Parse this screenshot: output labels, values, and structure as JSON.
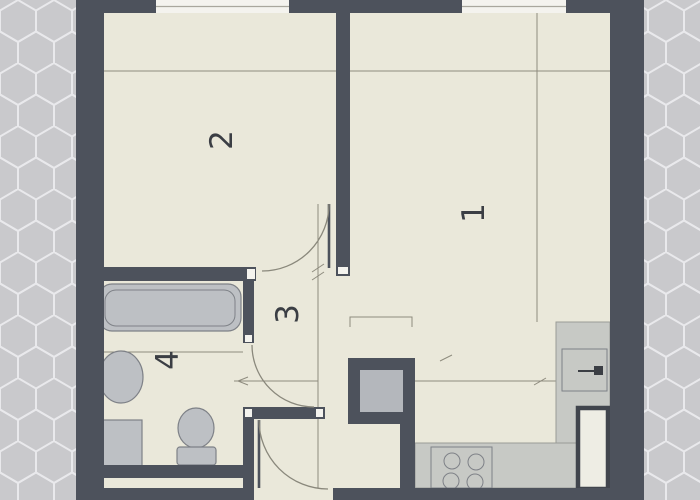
{
  "plan": {
    "rooms": [
      {
        "label": "1"
      },
      {
        "label": "2"
      },
      {
        "label": "3"
      },
      {
        "label": "4"
      }
    ]
  },
  "colors": {
    "hex-bg": "#c9c9cc",
    "hex-line": "#e9e9ec",
    "paper": "#eae8da",
    "wall": "#4d525c",
    "wall-cap": "#f4f3ee",
    "window": "#f4f3ee",
    "sill": "#a9a79d",
    "fixture-fill": "#bdc0c4",
    "fixture-stroke": "#7e8187",
    "counter-fill": "#c7c9c5",
    "counter-stroke": "#9a9c97",
    "shaft-fill": "#b4b7bc",
    "thin-line": "#8e8b7e",
    "door-arc": "#8a887c",
    "label": "#3b3e44",
    "fridge-fill": "#eeede4",
    "fridge-stroke": "#41454d"
  }
}
